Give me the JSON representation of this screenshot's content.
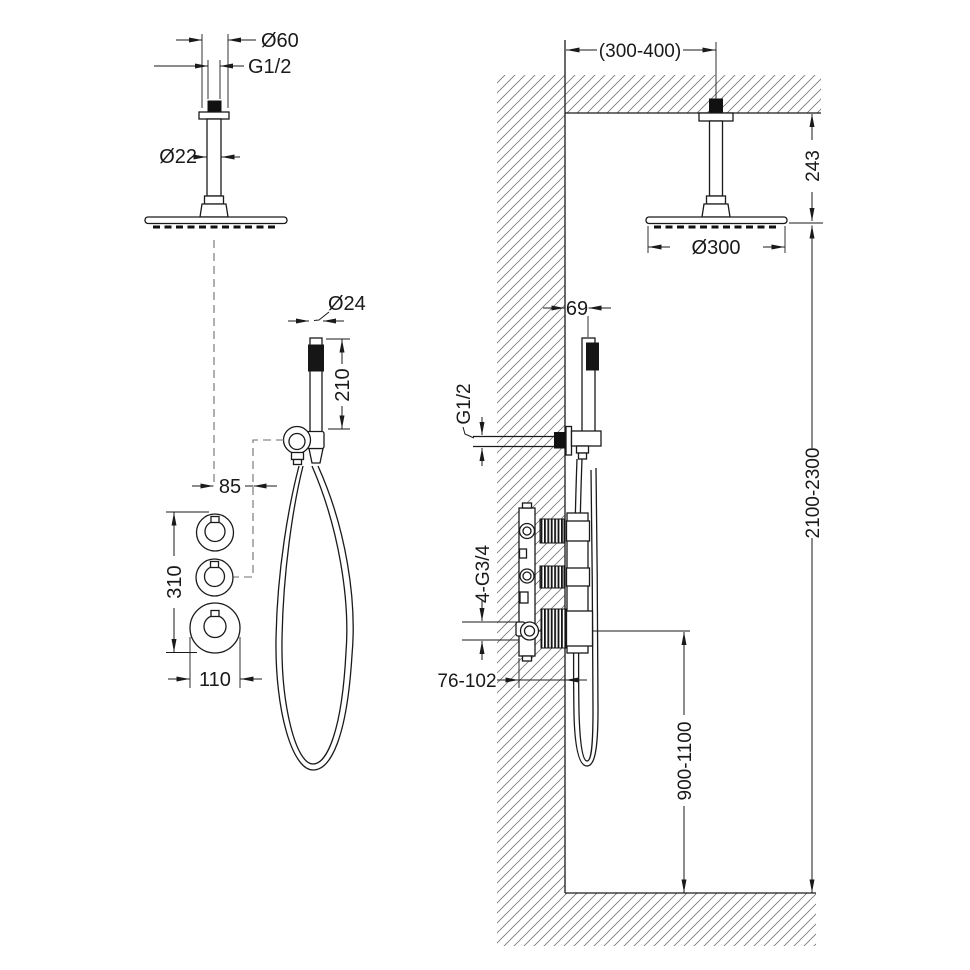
{
  "product": {
    "labels": {
      "head_diameter": "Ø60",
      "head_thread": "G1/2",
      "arm_diameter": "Ø22",
      "hand_shower_diameter": "Ø24",
      "hand_shower_length": "210",
      "hand_shower_offset": "85",
      "valve_group_height": "310",
      "valve_knob_diameter": "110"
    }
  },
  "installation": {
    "labels": {
      "head_distance_from_wall": "(300-400)",
      "ceiling_to_head": "243",
      "head_diameter": "Ø300",
      "hand_shower_distance_from_wall": "69",
      "outlet_thread": "G1/2",
      "valve_connections": "4-G3/4",
      "recessed_depth": "76-102",
      "valve_height_from_floor": "900-1100",
      "head_height_from_floor": "2100-2300"
    }
  },
  "colors": {
    "line": "#1a1a1a",
    "hatch": "#777777",
    "background": "#ffffff"
  }
}
